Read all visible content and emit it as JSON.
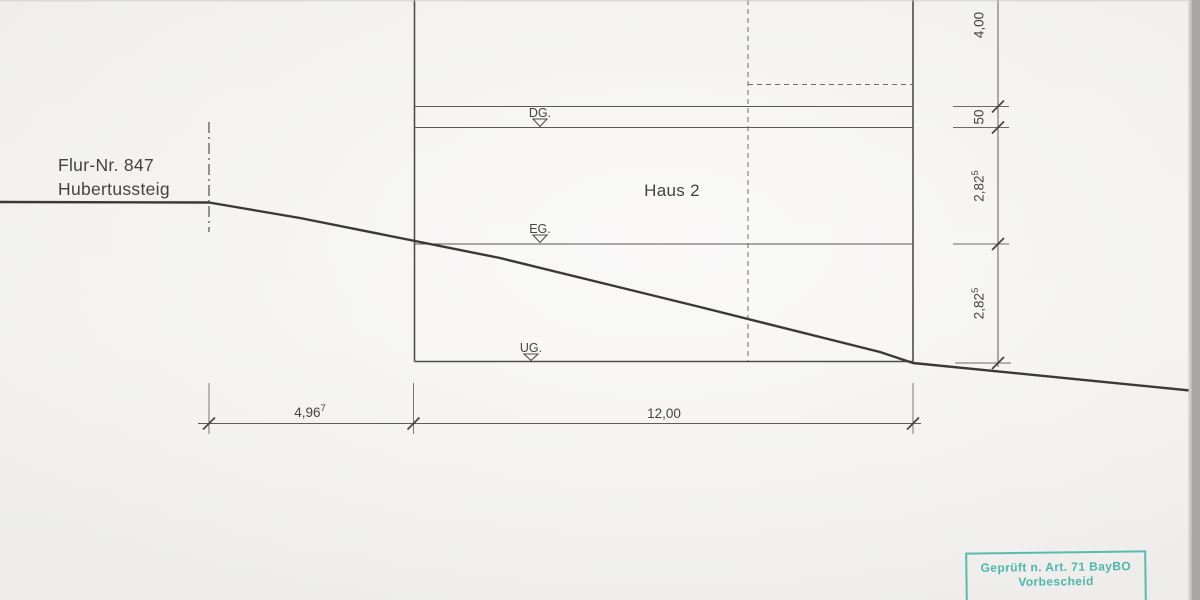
{
  "site_label": {
    "line1": "Flur-Nr. 847",
    "line2": "Hubertussteig"
  },
  "building": {
    "name": "Haus 2",
    "levels": [
      {
        "label": "DG."
      },
      {
        "label": "EG."
      },
      {
        "label": "UG."
      }
    ]
  },
  "dimensions": {
    "horizontal": {
      "left": {
        "value": "4,96",
        "sup": "7"
      },
      "main": {
        "value": "12,00"
      }
    },
    "vertical": {
      "top": {
        "value": "4,00"
      },
      "slab": {
        "value": "50"
      },
      "upper": {
        "value": "2,82",
        "sup": "5"
      },
      "lower": {
        "value": "2,82",
        "sup": "5"
      }
    }
  },
  "stamp": {
    "line1": "Geprüft n. Art. 71 BayBO",
    "line2": "Vorbescheid",
    "color": "#3cb3a3"
  },
  "colors": {
    "paper": "#f4f3f1",
    "drawing_line": "#4f4d4a",
    "terrain_line": "#3b3936",
    "stamp_accent": "#3cb3a3"
  }
}
